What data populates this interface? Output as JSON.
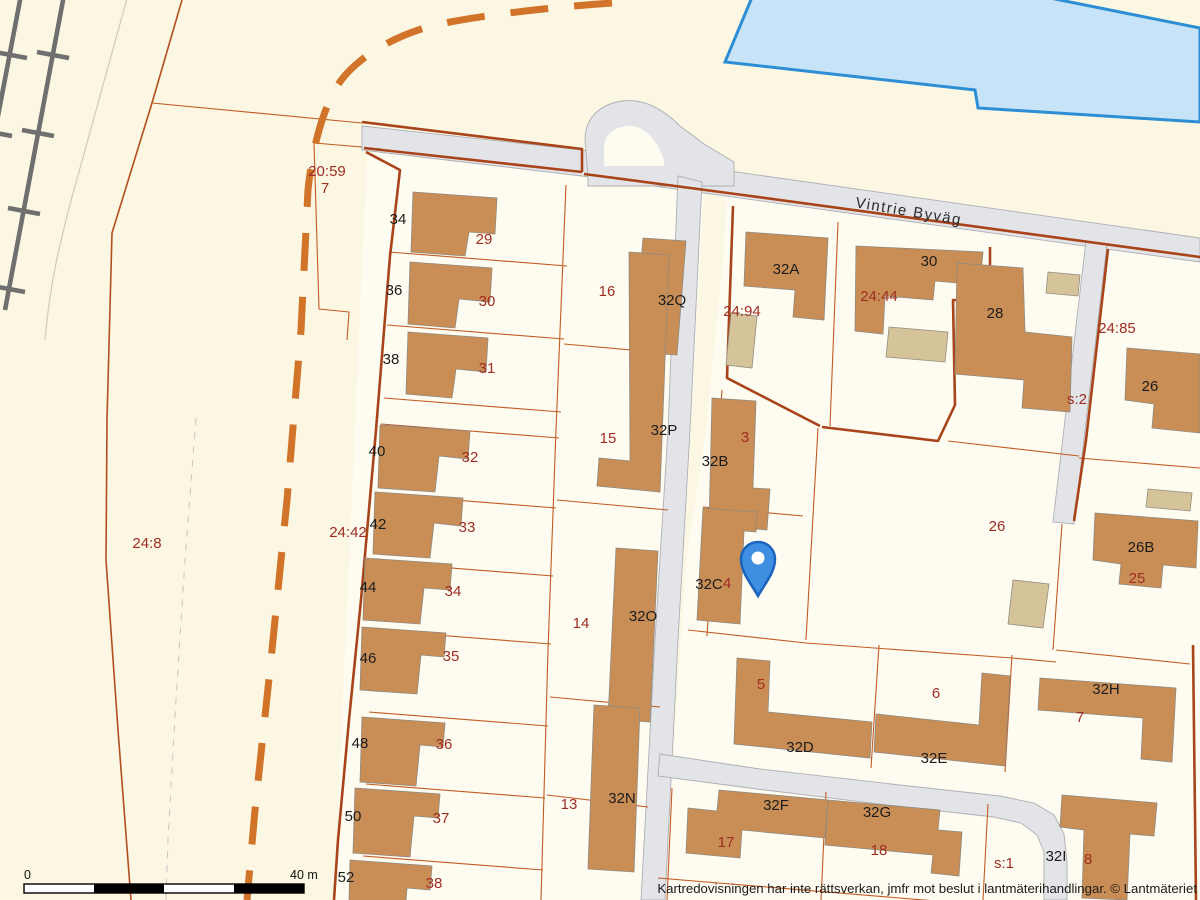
{
  "map": {
    "road_label": "Vintrie Byväg",
    "copyright": "Kartredovisningen har inte rättsverkan, jmfr mot beslut i lantmäterihandlingar. © Lantmäteriet",
    "scale": {
      "zero": "0",
      "forty": "40 m"
    },
    "palette": {
      "background": "#FBF7E2",
      "parcel_fill": "#FEFBF0",
      "building": "#C98E55",
      "outbuilding": "#D5C49A",
      "road": "#E3E4E8",
      "boundary_thick": "#A8431A",
      "boundary_thin": "#C25B24",
      "dashed_boundary": "#D2732A",
      "water_fill": "#C7E3F7",
      "water_stroke": "#2D8ED5",
      "railway": "#6F6F6F",
      "label_black": "#1C1C1C",
      "label_red": "#9E2D22",
      "pin_fill": "#3E8FE1",
      "pin_stroke": "#1B63BC"
    },
    "labels": [
      {
        "t": "34",
        "x": 398,
        "y": 224,
        "k": "b"
      },
      {
        "t": "36",
        "x": 394,
        "y": 295,
        "k": "b"
      },
      {
        "t": "38",
        "x": 391,
        "y": 364,
        "k": "b"
      },
      {
        "t": "40",
        "x": 377,
        "y": 456,
        "k": "b"
      },
      {
        "t": "42",
        "x": 378,
        "y": 529,
        "k": "b"
      },
      {
        "t": "44",
        "x": 368,
        "y": 592,
        "k": "b"
      },
      {
        "t": "46",
        "x": 368,
        "y": 663,
        "k": "b"
      },
      {
        "t": "48",
        "x": 360,
        "y": 748,
        "k": "b"
      },
      {
        "t": "50",
        "x": 353,
        "y": 821,
        "k": "b"
      },
      {
        "t": "52",
        "x": 346,
        "y": 882,
        "k": "b"
      },
      {
        "t": "29",
        "x": 484,
        "y": 244,
        "k": "r"
      },
      {
        "t": "30",
        "x": 487,
        "y": 306,
        "k": "r"
      },
      {
        "t": "31",
        "x": 487,
        "y": 373,
        "k": "r"
      },
      {
        "t": "32",
        "x": 470,
        "y": 462,
        "k": "r"
      },
      {
        "t": "33",
        "x": 467,
        "y": 532,
        "k": "r"
      },
      {
        "t": "34",
        "x": 453,
        "y": 596,
        "k": "r"
      },
      {
        "t": "35",
        "x": 451,
        "y": 661,
        "k": "r"
      },
      {
        "t": "36",
        "x": 444,
        "y": 749,
        "k": "r"
      },
      {
        "t": "37",
        "x": 441,
        "y": 823,
        "k": "r"
      },
      {
        "t": "38",
        "x": 434,
        "y": 888,
        "k": "r"
      },
      {
        "t": "20:59",
        "x": 327,
        "y": 176,
        "k": "r"
      },
      {
        "t": "7",
        "x": 325,
        "y": 193,
        "k": "r"
      },
      {
        "t": "24:8",
        "x": 147,
        "y": 548,
        "k": "r"
      },
      {
        "t": "24:42",
        "x": 348,
        "y": 537,
        "k": "r"
      },
      {
        "t": "16",
        "x": 607,
        "y": 296,
        "k": "r"
      },
      {
        "t": "15",
        "x": 608,
        "y": 443,
        "k": "r"
      },
      {
        "t": "14",
        "x": 581,
        "y": 628,
        "k": "r"
      },
      {
        "t": "13",
        "x": 569,
        "y": 809,
        "k": "r"
      },
      {
        "t": "32Q",
        "x": 672,
        "y": 305,
        "k": "b"
      },
      {
        "t": "32P",
        "x": 664,
        "y": 435,
        "k": "b"
      },
      {
        "t": "32O",
        "x": 643,
        "y": 621,
        "k": "b"
      },
      {
        "t": "32N",
        "x": 622,
        "y": 803,
        "k": "b"
      },
      {
        "t": "32A",
        "x": 786,
        "y": 274,
        "k": "b"
      },
      {
        "t": "32B",
        "x": 715,
        "y": 466,
        "k": "b"
      },
      {
        "t": "32C",
        "x": 709,
        "y": 589,
        "k": "b"
      },
      {
        "t": "24:94",
        "x": 742,
        "y": 316,
        "k": "r"
      },
      {
        "t": "3",
        "x": 745,
        "y": 442,
        "k": "r"
      },
      {
        "t": "4",
        "x": 727,
        "y": 588,
        "k": "r"
      },
      {
        "t": "24:44",
        "x": 879,
        "y": 301,
        "k": "r"
      },
      {
        "t": "30",
        "x": 929,
        "y": 266,
        "k": "b"
      },
      {
        "t": "28",
        "x": 995,
        "y": 318,
        "k": "b"
      },
      {
        "t": "24:85",
        "x": 1117,
        "y": 333,
        "k": "r"
      },
      {
        "t": "s:2",
        "x": 1077,
        "y": 404,
        "k": "r"
      },
      {
        "t": "26",
        "x": 1150,
        "y": 391,
        "k": "b"
      },
      {
        "t": "26",
        "x": 997,
        "y": 531,
        "k": "r"
      },
      {
        "t": "26B",
        "x": 1141,
        "y": 552,
        "k": "b"
      },
      {
        "t": "25",
        "x": 1137,
        "y": 583,
        "k": "r"
      },
      {
        "t": "5",
        "x": 761,
        "y": 689,
        "k": "r"
      },
      {
        "t": "6",
        "x": 936,
        "y": 698,
        "k": "r"
      },
      {
        "t": "32D",
        "x": 800,
        "y": 752,
        "k": "b"
      },
      {
        "t": "32E",
        "x": 934,
        "y": 763,
        "k": "b"
      },
      {
        "t": "32H",
        "x": 1106,
        "y": 694,
        "k": "b"
      },
      {
        "t": "7",
        "x": 1080,
        "y": 722,
        "k": "r"
      },
      {
        "t": "32F",
        "x": 776,
        "y": 810,
        "k": "b"
      },
      {
        "t": "17",
        "x": 726,
        "y": 847,
        "k": "r"
      },
      {
        "t": "32G",
        "x": 877,
        "y": 817,
        "k": "b"
      },
      {
        "t": "18",
        "x": 879,
        "y": 855,
        "k": "r"
      },
      {
        "t": "s:1",
        "x": 1004,
        "y": 868,
        "k": "r"
      },
      {
        "t": "32I",
        "x": 1056,
        "y": 861,
        "k": "b"
      },
      {
        "t": "8",
        "x": 1088,
        "y": 864,
        "k": "r"
      }
    ]
  }
}
